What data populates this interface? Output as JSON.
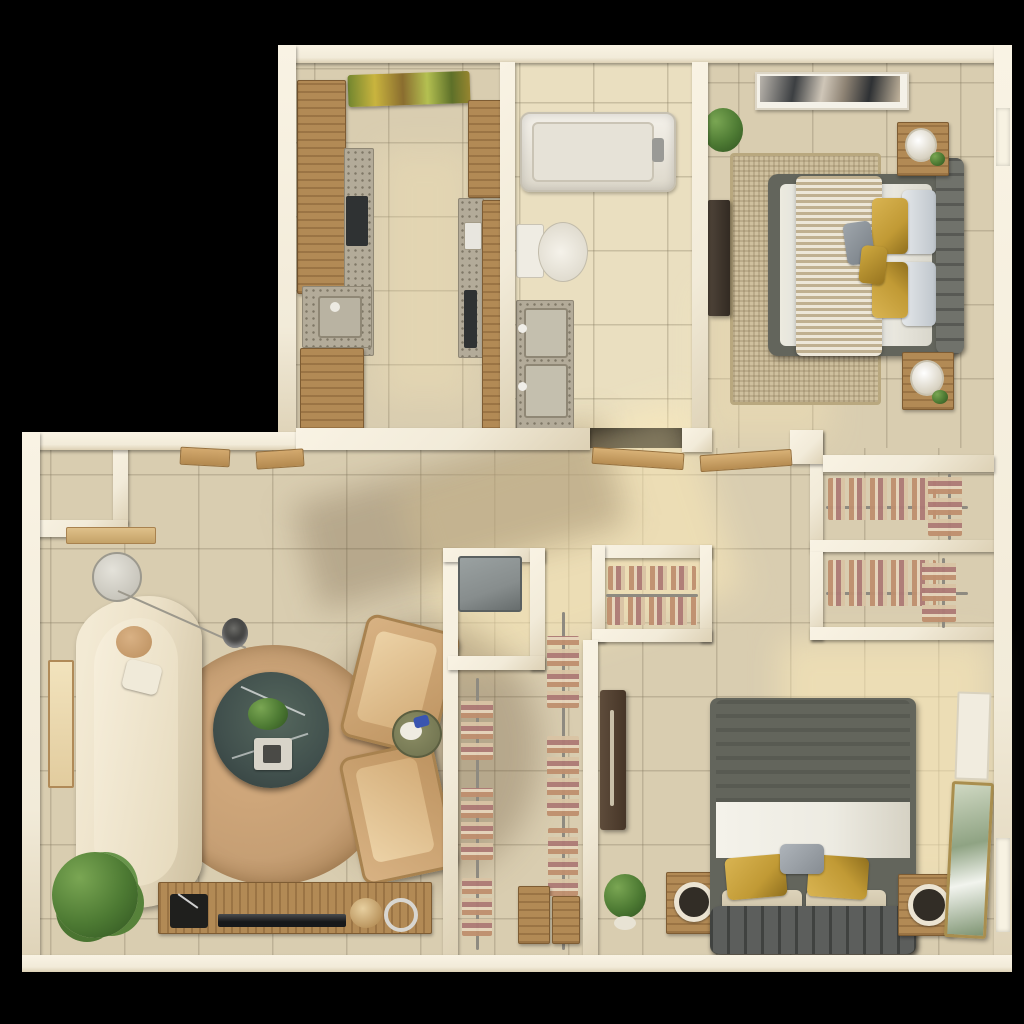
{
  "scene": {
    "title": "3D top-down floor plan render of a two-bedroom apartment",
    "view": "top-down 3D dollhouse render",
    "no_visible_text": true
  },
  "palette": {
    "bg": "#000000",
    "wall": "#f2ebd9",
    "wall-light": "#f9f3e4",
    "wall-dark": "#ddd1b5",
    "floor": "#d9cdb0",
    "floor-light": "#eadfc0",
    "wood": "#b28a55",
    "wood-dark": "#7e5c33",
    "granite": "#b3ab99",
    "appliance": "#2f3233",
    "laundry-gray": "#878d8d",
    "sofa-cream": "#ece1c8",
    "rug-living": "#c69f74",
    "rug-bed1": "#cfc09e",
    "marble-table": "#41504d",
    "bed1-frame": "#63655c",
    "bed2-duvet": "#7b7466",
    "gold": "#c19a35",
    "linen-white": "#edebe2",
    "plant-green": "#4d7a33",
    "accent-blue": "#3a55b0",
    "rod": "#8e8a80"
  },
  "rooms": {
    "kitchen": {
      "name": "Kitchen",
      "furniture": [
        "upper wood cabinets",
        "granite counter with dark cooktop",
        "granite sink with faucet",
        "lower wood cabinets",
        "tall wood cabinet",
        "wall oven",
        "colorful runner rug"
      ]
    },
    "bathroom": {
      "name": "Bathroom",
      "furniture": [
        "bathtub with faucet",
        "toilet",
        "double-basin granite vanity"
      ]
    },
    "bedroom1": {
      "name": "Bedroom 1",
      "furniture": [
        "bed with gray tufted headboard",
        "chunky knit throw",
        "gold and gray pillows",
        "jute area rug",
        "two wood nightstands with lamps and plants",
        "abstract wall art",
        "potted plant",
        "dark media dresser"
      ]
    },
    "hallway": {
      "name": "Hallway",
      "furniture": [
        "open wood door leaves"
      ]
    },
    "entry": {
      "name": "Entry alcove",
      "furniture": [
        "wall shelf",
        "open entry doors"
      ]
    },
    "living": {
      "name": "Living room",
      "furniture": [
        "curved cream boucle sofa",
        "arc floor lamp",
        "round tan area rug",
        "round dark marble coffee table with plant and tray",
        "two beige lounge chairs",
        "small round side table with blue decor",
        "wood media console with turntable, TV and gold decor",
        "large floor plant",
        "leaning art panel"
      ]
    },
    "laundry": {
      "name": "Laundry closet",
      "furniture": [
        "gray appliance"
      ]
    },
    "walkin": {
      "name": "Walk-in closet",
      "furniture": [
        "two vertical garment rods with hanging clothes",
        "wood storage crates"
      ]
    },
    "closetMid": {
      "name": "Closet",
      "furniture": [
        "garment rod with hanging clothes",
        "shelf with folded clothes"
      ]
    },
    "closetA": {
      "name": "Closet",
      "furniture": [
        "garment rod with hanging clothes",
        "side rod with clothes"
      ]
    },
    "closetB": {
      "name": "Closet",
      "furniture": [
        "garment rod with hanging clothes",
        "side rod with clothes"
      ]
    },
    "bedroom2": {
      "name": "Bedroom 2",
      "furniture": [
        "bed with dark gray duvet and white sheet",
        "gold velvet and gray pillows",
        "channel-tufted footboard bench",
        "two wood nightstands with ring speakers",
        "dark dresser",
        "gold-framed leaning mirror",
        "white leaning panel",
        "potted plant"
      ]
    }
  }
}
